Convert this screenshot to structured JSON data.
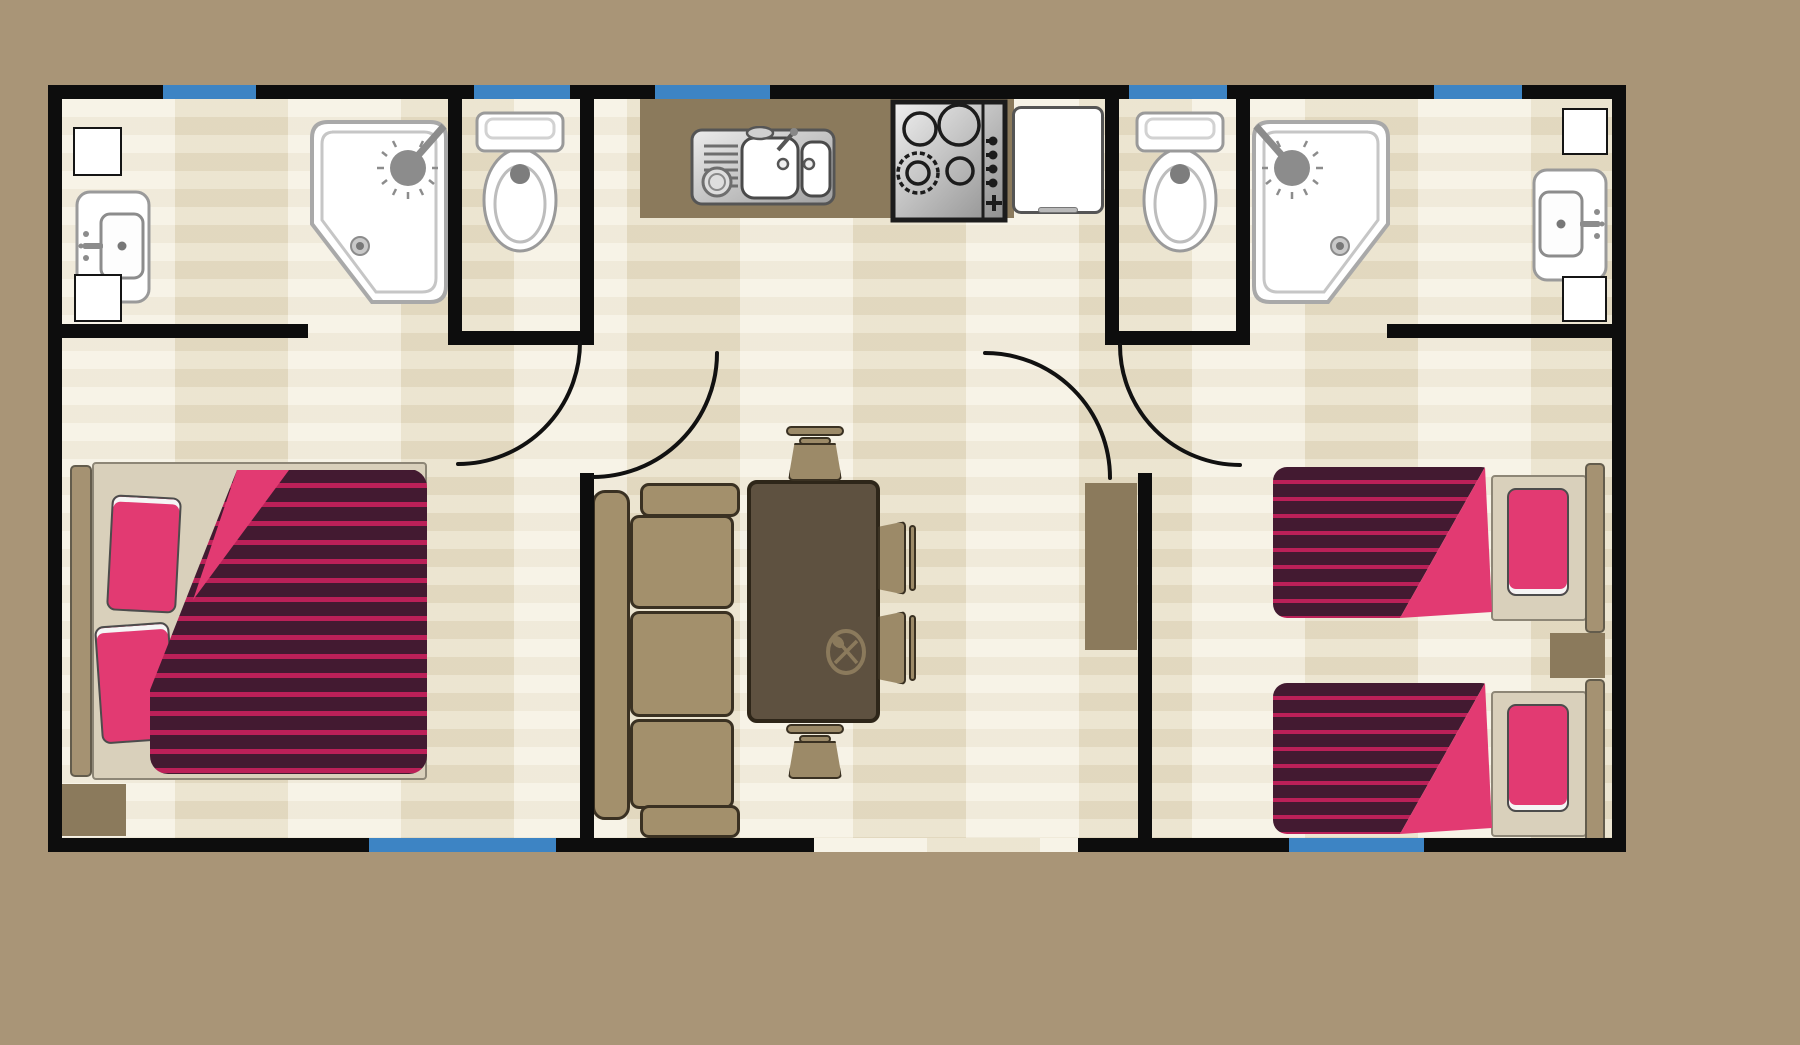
{
  "canvas": {
    "width": 1800,
    "height": 1045,
    "background": "#a99577"
  },
  "colors": {
    "background_tan": "#a99577",
    "wall_black": "#0d0d0d",
    "window_blue": "#3d84c4",
    "floor_light": "#f3edda",
    "floor_dark": "#e8dfc7",
    "wood_brown": "#8b7a5c",
    "furniture_tan": "#a3906c",
    "table_brown": "#5e5140",
    "duvet_plum": "#431a31",
    "duvet_stripe_pink": "#bb2058",
    "pillow_pink": "#e23a72",
    "fixture_white": "#ffffff",
    "fixture_gray": "#9a9a9a"
  },
  "floor": {
    "main": {
      "x": 62,
      "y": 99,
      "w": 1550,
      "h": 739
    },
    "entrance_patch": {
      "x": 814,
      "y": 838,
      "w": 264,
      "h": 14
    }
  },
  "walls": [
    {
      "name": "wall-outer-top",
      "x": 48,
      "y": 85,
      "w": 1578,
      "h": 14
    },
    {
      "name": "wall-outer-left",
      "x": 48,
      "y": 85,
      "w": 14,
      "h": 767
    },
    {
      "name": "wall-outer-right",
      "x": 1612,
      "y": 85,
      "w": 14,
      "h": 767
    },
    {
      "name": "wall-outer-bottom-left",
      "x": 48,
      "y": 838,
      "w": 766,
      "h": 14
    },
    {
      "name": "wall-outer-bottom-right",
      "x": 1078,
      "y": 838,
      "w": 548,
      "h": 14
    },
    {
      "name": "wall-bathroom-left-bottom",
      "x": 62,
      "y": 324,
      "w": 246,
      "h": 14
    },
    {
      "name": "wall-wc-left-west",
      "x": 448,
      "y": 99,
      "w": 14,
      "h": 246
    },
    {
      "name": "wall-wc-left-bottom",
      "x": 448,
      "y": 331,
      "w": 132,
      "h": 14
    },
    {
      "name": "wall-divider-left-top",
      "x": 580,
      "y": 99,
      "w": 14,
      "h": 246
    },
    {
      "name": "wall-divider-left-bottom",
      "x": 580,
      "y": 473,
      "w": 14,
      "h": 365
    },
    {
      "name": "wall-wc-right-west",
      "x": 1105,
      "y": 99,
      "w": 14,
      "h": 246
    },
    {
      "name": "wall-wc-right-bottom",
      "x": 1119,
      "y": 331,
      "w": 131,
      "h": 14
    },
    {
      "name": "wall-wc-right-east",
      "x": 1236,
      "y": 99,
      "w": 14,
      "h": 246
    },
    {
      "name": "wall-divider-right-bottom",
      "x": 1138,
      "y": 473,
      "w": 14,
      "h": 365
    },
    {
      "name": "wall-bathroom-right-bottom",
      "x": 1387,
      "y": 324,
      "w": 225,
      "h": 14
    }
  ],
  "windows": [
    {
      "name": "window-top-1",
      "x": 163,
      "y": 85,
      "w": 93,
      "h": 14
    },
    {
      "name": "window-top-2",
      "x": 474,
      "y": 85,
      "w": 96,
      "h": 14
    },
    {
      "name": "window-top-3",
      "x": 655,
      "y": 85,
      "w": 115,
      "h": 14
    },
    {
      "name": "window-top-4",
      "x": 1129,
      "y": 85,
      "w": 98,
      "h": 14
    },
    {
      "name": "window-top-5",
      "x": 1434,
      "y": 85,
      "w": 88,
      "h": 14
    },
    {
      "name": "window-bottom-1",
      "x": 369,
      "y": 838,
      "w": 187,
      "h": 14
    },
    {
      "name": "window-bottom-2",
      "x": 1289,
      "y": 838,
      "w": 135,
      "h": 14
    }
  ],
  "door_arcs": [
    {
      "name": "door-arc-bedroom-left",
      "path": "M580,342 A122,122 0 0 1 458,464"
    },
    {
      "name": "door-arc-living-room",
      "path": "M717,353 A124,124 0 0 1 593,477"
    },
    {
      "name": "door-arc-hallway",
      "path": "M985,353 A125,125 0 0 1 1110,478"
    },
    {
      "name": "door-arc-bedroom-right",
      "path": "M1120,345 A120,120 0 0 0 1240,465"
    }
  ],
  "furniture": [
    {
      "name": "cabinet-top-left",
      "kind": "white-box",
      "x": 73,
      "y": 127,
      "w": 49,
      "h": 49
    },
    {
      "name": "washbasin-left",
      "kind": "sink",
      "x": 75,
      "y": 190,
      "w": 76,
      "h": 114,
      "flip": false
    },
    {
      "name": "cabinet-bottom-left",
      "kind": "white-box",
      "x": 74,
      "y": 274,
      "w": 48,
      "h": 48
    },
    {
      "name": "shower-left",
      "kind": "shower",
      "x": 308,
      "y": 118,
      "w": 142,
      "h": 188,
      "flip": false
    },
    {
      "name": "toilet-left",
      "kind": "toilet",
      "x": 474,
      "y": 110,
      "w": 92,
      "h": 145
    },
    {
      "name": "kitchen-counter",
      "kind": "counter",
      "x": 640,
      "y": 99,
      "w": 374,
      "h": 119
    },
    {
      "name": "kitchen-sink",
      "kind": "ksink",
      "x": 690,
      "y": 126,
      "w": 146,
      "h": 82
    },
    {
      "name": "stove",
      "kind": "stove",
      "x": 890,
      "y": 99,
      "w": 118,
      "h": 124
    },
    {
      "name": "fridge",
      "kind": "fridge",
      "x": 1012,
      "y": 106,
      "w": 92,
      "h": 108
    },
    {
      "name": "toilet-right",
      "kind": "toilet",
      "x": 1134,
      "y": 110,
      "w": 92,
      "h": 145
    },
    {
      "name": "shower-right",
      "kind": "shower",
      "x": 1250,
      "y": 118,
      "w": 142,
      "h": 188,
      "flip": true
    },
    {
      "name": "cabinet-top-right",
      "kind": "white-box",
      "x": 1562,
      "y": 108,
      "w": 46,
      "h": 47
    },
    {
      "name": "washbasin-right",
      "kind": "sink",
      "x": 1532,
      "y": 168,
      "w": 76,
      "h": 114,
      "flip": true
    },
    {
      "name": "cabinet-bottom-right",
      "kind": "white-box",
      "x": 1562,
      "y": 276,
      "w": 45,
      "h": 46
    },
    {
      "name": "double-bed",
      "kind": "bed-double",
      "x": 70,
      "y": 462,
      "w": 357,
      "h": 318
    },
    {
      "name": "mat-bottom-left",
      "kind": "brown-box",
      "x": 62,
      "y": 784,
      "w": 64,
      "h": 52
    },
    {
      "name": "sofa",
      "kind": "sofa",
      "x": 592,
      "y": 483,
      "w": 148,
      "h": 355
    },
    {
      "name": "dining-table",
      "kind": "table",
      "x": 747,
      "y": 480,
      "w": 133,
      "h": 243
    },
    {
      "name": "chair-top",
      "kind": "chair-v",
      "x": 783,
      "y": 424,
      "w": 64,
      "h": 57,
      "flip": false
    },
    {
      "name": "chair-bottom",
      "kind": "chair-v",
      "x": 783,
      "y": 722,
      "w": 64,
      "h": 57,
      "flip": true
    },
    {
      "name": "chair-right-1",
      "kind": "chair-h",
      "x": 878,
      "y": 518,
      "w": 42,
      "h": 80
    },
    {
      "name": "chair-right-2",
      "kind": "chair-h",
      "x": 878,
      "y": 608,
      "w": 42,
      "h": 80
    },
    {
      "name": "wardrobe",
      "kind": "brown-box",
      "x": 1085,
      "y": 483,
      "w": 52,
      "h": 167
    },
    {
      "name": "single-bed-top",
      "kind": "bed-single",
      "x": 1273,
      "y": 462,
      "w": 332,
      "h": 172
    },
    {
      "name": "nightstand",
      "kind": "brown-box",
      "x": 1550,
      "y": 633,
      "w": 55,
      "h": 45
    },
    {
      "name": "single-bed-bottom",
      "kind": "bed-single",
      "x": 1273,
      "y": 678,
      "w": 332,
      "h": 172
    }
  ]
}
